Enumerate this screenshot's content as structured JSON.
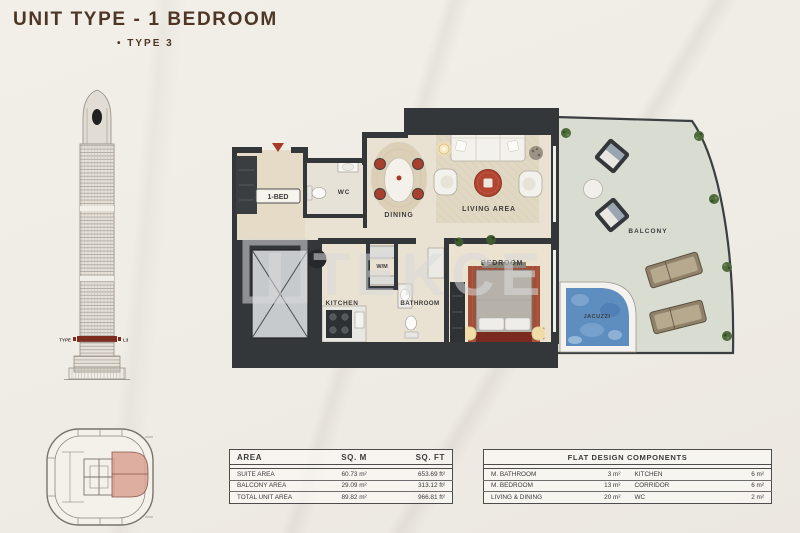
{
  "header": {
    "title": "UNIT TYPE - 1 BEDROOM",
    "subtitle": "• TYPE 3"
  },
  "tower": {
    "level_label_left": "TYPE",
    "level_label_right": "L3"
  },
  "watermark": {
    "text": "TEKCE"
  },
  "plan": {
    "rooms": {
      "entry": "1-BED",
      "wc": "WC",
      "dining": "DINING",
      "living": "LIVING AREA",
      "kitchen": "KITCHEN",
      "wm": "W/M",
      "bathroom": "BATHROOM",
      "bedroom": "BEDROOM",
      "balcony": "BALCONY",
      "jacuzzi": "JACUZZI"
    }
  },
  "tables": {
    "area": {
      "headers": [
        "AREA",
        "SQ. M",
        "SQ. FT"
      ],
      "rows": [
        [
          "SUITE AREA",
          "60.73 m²",
          "653.69 ft²"
        ],
        [
          "BALCONY AREA",
          "29.09 m²",
          "313.12 ft²"
        ],
        [
          "TOTAL UNIT AREA",
          "89.82 m²",
          "966.81 ft²"
        ]
      ]
    },
    "components": {
      "title": "FLAT DESIGN COMPONENTS",
      "rows": [
        [
          "M. BATHROOM",
          "3 m²",
          "KITCHEN",
          "6 m²"
        ],
        [
          "M. BEDROOM",
          "13 m²",
          "CORRIDOR",
          "6 m²"
        ],
        [
          "LIVING & DINING",
          "20 m²",
          "WC",
          "2 m²"
        ]
      ]
    }
  },
  "colors": {
    "title_brown": "#4e3625",
    "wall": "#33373a",
    "accent_red": "#a83a28",
    "balcony_floor": "#d9dcd1",
    "jacuzzi_blue": "#5e8ec0",
    "keyplan_highlight": "#d9a294"
  }
}
